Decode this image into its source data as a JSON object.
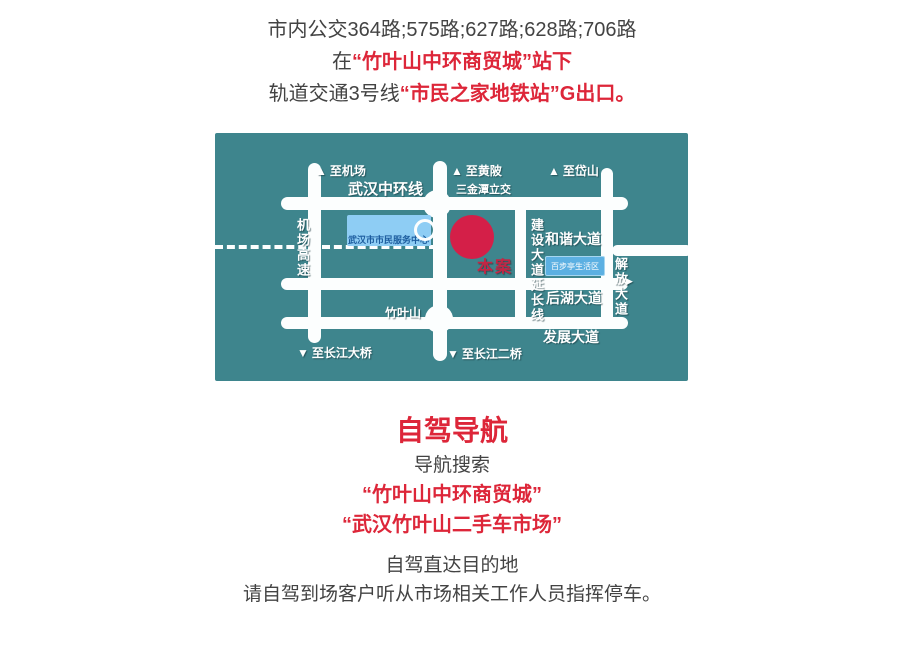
{
  "page": {
    "background": "#ffffff",
    "text_color": "#434343",
    "accent_red": "#dd2639"
  },
  "icons": {
    "up_arrow": "▲",
    "down_arrow": "▼",
    "right_arrow": "▶"
  },
  "transit": {
    "bus_line": "市内公交364路;575路;627路;628路;706路",
    "stop_prefix": "在",
    "stop_red": "“竹叶山中环商贸城”站下",
    "metro_prefix": "轨道交通3号线",
    "metro_red": "“市民之家地铁站”G出口。"
  },
  "map": {
    "background": "#3e858d",
    "road_color": "#fcfefe",
    "marker_color": "#d41f48",
    "labels": {
      "to_airport": "至机场",
      "ring_road": "武汉中环线",
      "to_huangpi": "至黄陂",
      "sanjintan": "三金潭立交",
      "to_daishan": "至岱山",
      "airport_expressway": "机场高速",
      "service_center": "武汉市市民服务中心",
      "site_marker": "本案",
      "jianshe_ext": "建设大道延长线",
      "hexie_ave": "和谐大道",
      "baibuting": "百步亭生活区",
      "jiefang_ave": "解放大道",
      "houhu_ave": "后湖大道",
      "zhuyeshan": "竹叶山",
      "fazhan_ave": "发展大道",
      "to_changjiang_bridge": "至长江大桥",
      "to_changjiang2_bridge": "至长江二桥"
    }
  },
  "driving": {
    "title": "自驾导航",
    "subtitle": "导航搜索",
    "search1": "“竹叶山中环商贸城”",
    "search2": "“武汉竹叶山二手车市场”",
    "note1": "自驾直达目的地",
    "note2": "请自驾到场客户听从市场相关工作人员指挥停车。"
  }
}
